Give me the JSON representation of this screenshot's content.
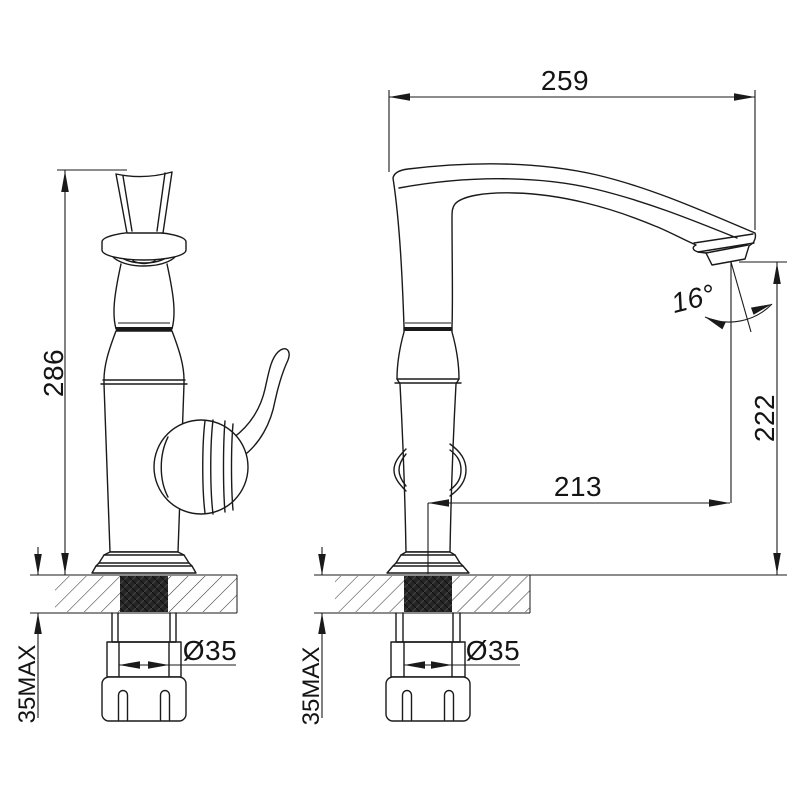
{
  "drawing": {
    "type": "technical dimension drawing",
    "subject": "single-handle kitchen faucet, front and side views with installation dimensions",
    "colors": {
      "line": "#1a1a1a",
      "background": "#ffffff",
      "shank_fill": "#262626"
    },
    "labels": {
      "height_overall": "286",
      "reach_overall": "259",
      "outlet_height": "222",
      "outlet_reach": "213",
      "outlet_angle": "16°",
      "hole_dia_front": "Ø35",
      "hole_dia_side": "Ø35",
      "deck_max_front": "35MAX",
      "deck_max_side": "35MAX"
    }
  }
}
